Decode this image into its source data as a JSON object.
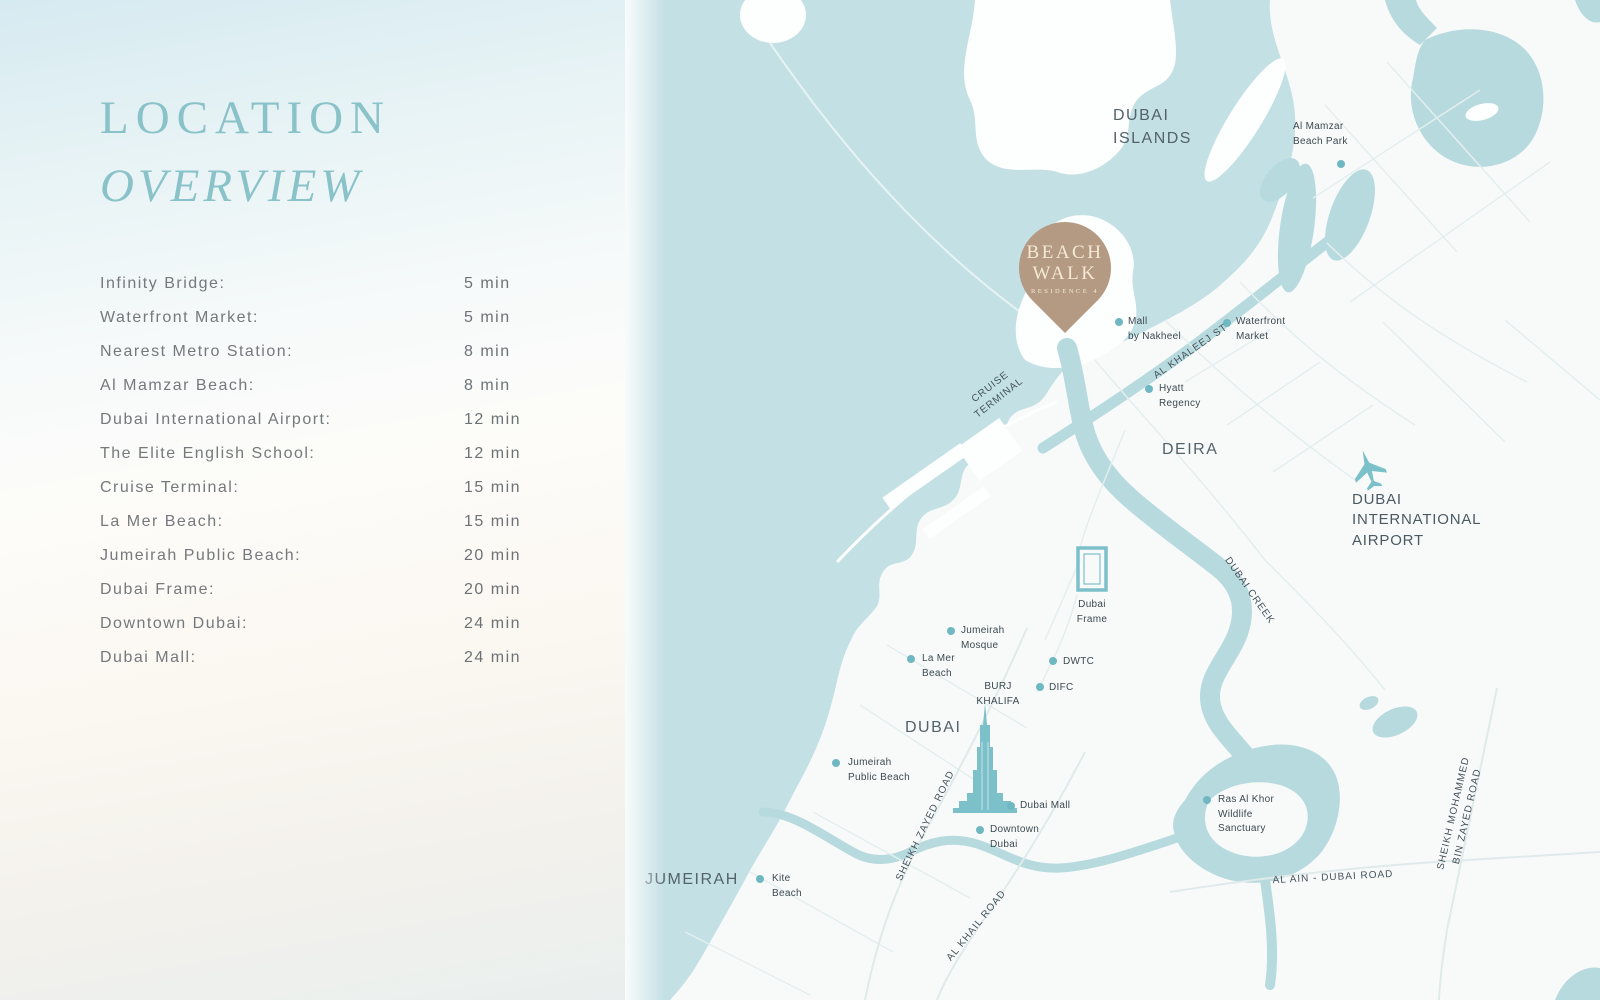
{
  "panel": {
    "title": {
      "line1": "LOCATION",
      "line2": "OVERVIEW"
    },
    "rows": [
      {
        "label": "Infinity Bridge:",
        "time": "5 min"
      },
      {
        "label": "Waterfront Market:",
        "time": "5 min"
      },
      {
        "label": "Nearest Metro Station:",
        "time": "8 min"
      },
      {
        "label": "Al Mamzar Beach:",
        "time": "8 min"
      },
      {
        "label": "Dubai International Airport:",
        "time": "12 min"
      },
      {
        "label": "The Elite English School:",
        "time": "12 min"
      },
      {
        "label": "Cruise Terminal:",
        "time": "15 min"
      },
      {
        "label": "La Mer Beach:",
        "time": "15 min"
      },
      {
        "label": "Jumeirah Public Beach:",
        "time": "20 min"
      },
      {
        "label": "Dubai Frame:",
        "time": "20 min"
      },
      {
        "label": "Downtown Dubai:",
        "time": "24 min"
      },
      {
        "label": "Dubai Mall:",
        "time": "24 min"
      }
    ]
  },
  "map": {
    "pin": {
      "line1": "BEACH",
      "line2": "WALK",
      "line3": "RESIDENCE 4"
    },
    "areas": {
      "dubai_islands": "DUBAI\nISLANDS",
      "deira": "DEIRA",
      "dubai": "DUBAI",
      "jumeirah": "JUMEIRAH"
    },
    "airport": "DUBAI\nINTERNATIONAL\nAIRPORT",
    "pois": {
      "al_mamzar": "Al Mamzar\nBeach Park",
      "mall_nakheel": "Mall\nby Nakheel",
      "waterfront_market": "Waterfront\nMarket",
      "hyatt": "Hyatt\nRegency",
      "jumeirah_mosque": "Jumeirah\nMosque",
      "la_mer": "La Mer\nBeach",
      "dwtc": "DWTC",
      "difc": "DIFC",
      "burj_khalifa": "BURJ\nKHALIFA",
      "dubai_frame": "Dubai\nFrame",
      "jumeirah_public_beach": "Jumeirah\nPublic Beach",
      "dubai_mall": "Dubai Mall",
      "downtown": "Downtown\nDubai",
      "kite_beach": "Kite\nBeach",
      "ras_al_khor": "Ras Al Khor\nWildlife\nSanctuary"
    },
    "roads": {
      "al_khaleej": "AL KHALEEJ ST",
      "cruise_terminal": "CRUISE\nTERMINAL",
      "dubai_creek": "DUBAI CREEK",
      "sheikh_zayed": "SHEIKH ZAYED ROAD",
      "al_khail": "AL KHAIL ROAD",
      "al_ain": "AL AIN - DUBAI ROAD",
      "smbz": "SHEIKH MOHAMMED\nBIN ZAYED ROAD"
    },
    "colors": {
      "water": "#c3e0e5",
      "land": "#f8fafa",
      "island": "#fdfefe",
      "creek": "#b7dade",
      "accent_teal": "#6fb7c1",
      "icon_teal": "#7cc0ca",
      "pin_brown": "#b49a82",
      "pin_text": "#f4e9d6",
      "title_teal": "#89c2c8",
      "text_gray": "#75797d"
    }
  }
}
